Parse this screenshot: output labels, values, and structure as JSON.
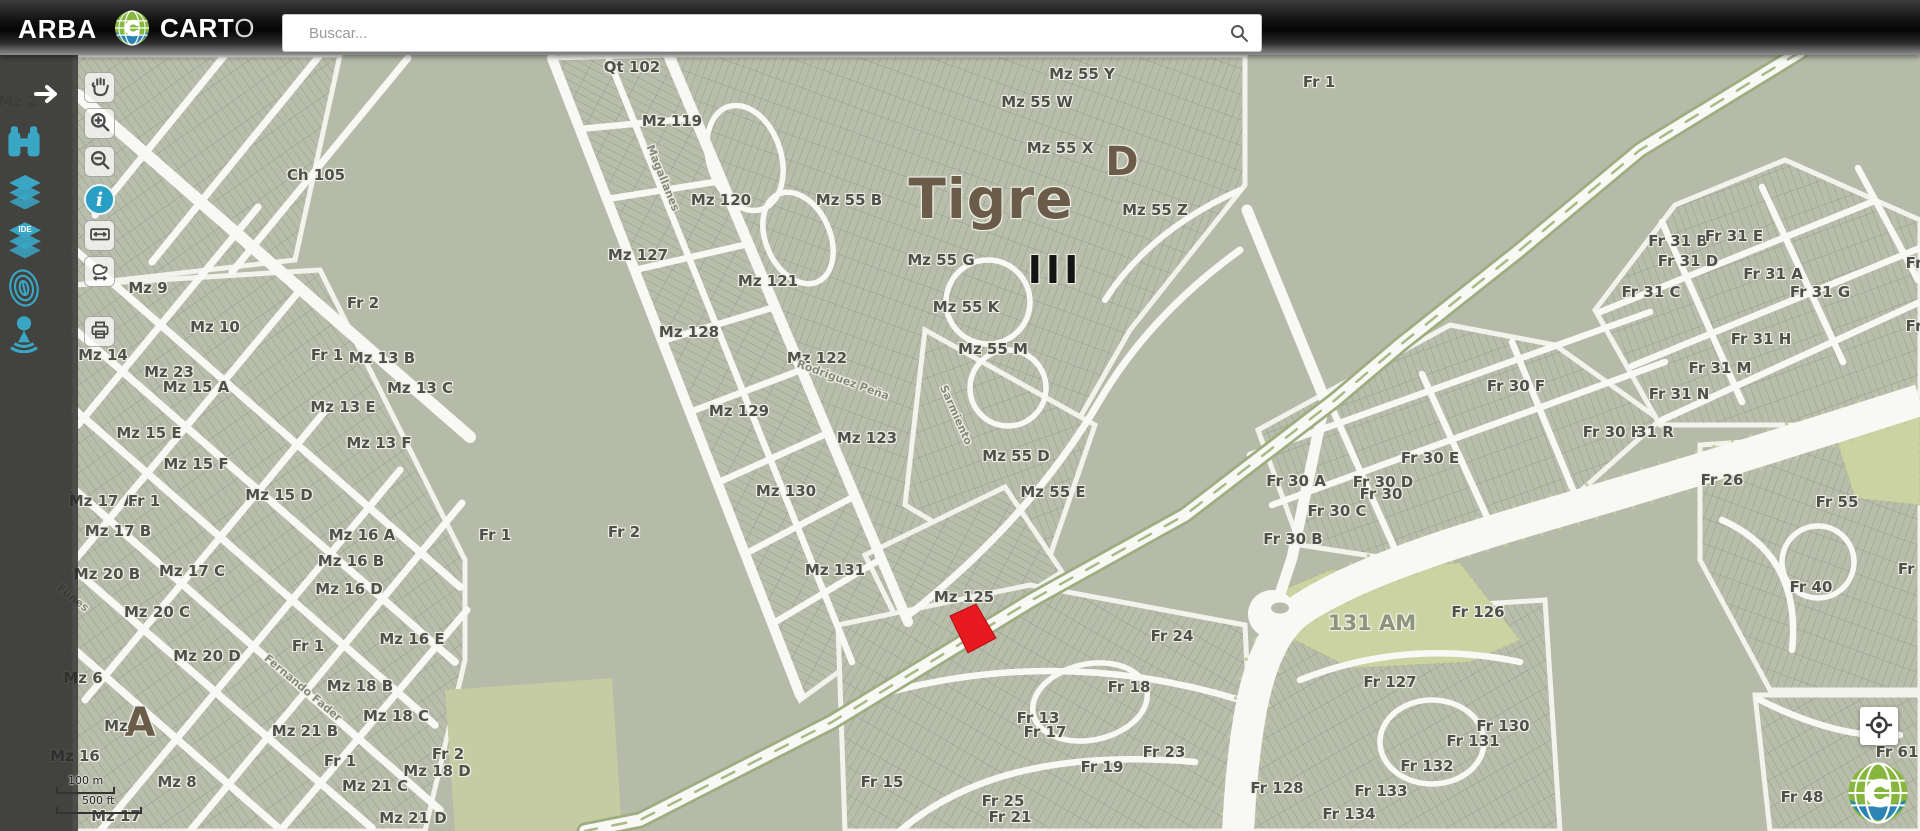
{
  "header": {
    "brand": "ARBA",
    "product": {
      "bold": "CART",
      "light": "O"
    },
    "search": {
      "placeholder": "Buscar...",
      "icon": "search-icon"
    },
    "actions": {
      "mail": {
        "icon": "mail-icon"
      },
      "help": {
        "icon": "help-icon",
        "glyph": "?"
      },
      "logout": {
        "icon": "exit-icon"
      }
    }
  },
  "sidebar": {
    "expand_icon": "arrow-right-icon",
    "tools": [
      {
        "name": "search-parcel",
        "icon": "binoculars-icon"
      },
      {
        "name": "layers",
        "icon": "layers-icon"
      },
      {
        "name": "ide-layers",
        "icon": "ide-layers-icon",
        "badge": "IDE"
      },
      {
        "name": "fingerprint",
        "icon": "fingerprint-icon"
      },
      {
        "name": "street-view",
        "icon": "street-view-icon"
      }
    ]
  },
  "toolbar": {
    "buttons": [
      {
        "name": "pan",
        "icon": "hand-icon",
        "active": false
      },
      {
        "name": "zoom-in",
        "icon": "zoom-in-icon",
        "active": false
      },
      {
        "name": "zoom-out",
        "icon": "zoom-out-icon",
        "active": false
      },
      {
        "name": "identify",
        "icon": "info-icon",
        "glyph": "i",
        "active": true
      },
      {
        "name": "measure-distance",
        "icon": "measure-distance-icon",
        "active": false
      },
      {
        "name": "measure-area",
        "icon": "measure-area-icon",
        "active": false
      },
      {
        "name": "print",
        "icon": "print-icon",
        "active": false
      }
    ]
  },
  "map": {
    "city": "Tigre",
    "selected_parcel_color": "#e8191f",
    "scale": {
      "metric": "100 m",
      "imperial": "500 ft"
    },
    "labels": [
      {
        "text": "Qt 102",
        "x": 632,
        "y": 67
      },
      {
        "text": "Mz 119",
        "x": 672,
        "y": 121
      },
      {
        "text": "Ch 105",
        "x": 316,
        "y": 175
      },
      {
        "text": "Mz 120",
        "x": 721,
        "y": 200
      },
      {
        "text": "Mz 55 B",
        "x": 849,
        "y": 200
      },
      {
        "text": "Mz 55 Y",
        "x": 1082,
        "y": 74
      },
      {
        "text": "Mz 55 W",
        "x": 1037,
        "y": 102
      },
      {
        "text": "Mz 55 X",
        "x": 1060,
        "y": 148
      },
      {
        "text": "D",
        "x": 1122,
        "y": 162,
        "cls": "sec"
      },
      {
        "text": "Mz 55 Z",
        "x": 1155,
        "y": 210
      },
      {
        "text": "Tigre",
        "x": 991,
        "y": 199,
        "cls": "city"
      },
      {
        "text": "Fr 1",
        "x": 1319,
        "y": 82
      },
      {
        "text": "Mz 127",
        "x": 638,
        "y": 255
      },
      {
        "text": "Mz 121",
        "x": 768,
        "y": 281
      },
      {
        "text": "Mz 55 G",
        "x": 941,
        "y": 260
      },
      {
        "text": "III",
        "x": 1055,
        "y": 270,
        "cls": "circ"
      },
      {
        "text": "Mz 9",
        "x": 148,
        "y": 288
      },
      {
        "text": "Fr 2",
        "x": 363,
        "y": 303
      },
      {
        "text": "Mz 10",
        "x": 215,
        "y": 327
      },
      {
        "text": "Mz 128",
        "x": 689,
        "y": 332
      },
      {
        "text": "Mz 55 K",
        "x": 966,
        "y": 307
      },
      {
        "text": "Mz 14",
        "x": 103,
        "y": 355
      },
      {
        "text": "Fr 1",
        "x": 327,
        "y": 355
      },
      {
        "text": "Mz 13 B",
        "x": 382,
        "y": 358
      },
      {
        "text": "Mz 122",
        "x": 817,
        "y": 358
      },
      {
        "text": "Mz 55 M",
        "x": 993,
        "y": 349
      },
      {
        "text": "Mz 23",
        "x": 169,
        "y": 372
      },
      {
        "text": "Mz 15 A",
        "x": 196,
        "y": 387
      },
      {
        "text": "Mz 13 C",
        "x": 420,
        "y": 388
      },
      {
        "text": "Mz 13 E",
        "x": 343,
        "y": 407
      },
      {
        "text": "Mz 129",
        "x": 739,
        "y": 411
      },
      {
        "text": "Mz 15 E",
        "x": 149,
        "y": 433
      },
      {
        "text": "Mz 13 F",
        "x": 379,
        "y": 443
      },
      {
        "text": "Mz 123",
        "x": 867,
        "y": 438
      },
      {
        "text": "Mz 55 D",
        "x": 1016,
        "y": 456
      },
      {
        "text": "Mz 15 F",
        "x": 196,
        "y": 464
      },
      {
        "text": "Mz 55 E",
        "x": 1053,
        "y": 492
      },
      {
        "text": "Mz 17 A",
        "x": 102,
        "y": 501
      },
      {
        "text": "Fr 1",
        "x": 144,
        "y": 501
      },
      {
        "text": "Mz 15 D",
        "x": 279,
        "y": 495
      },
      {
        "text": "Mz 130",
        "x": 786,
        "y": 491
      },
      {
        "text": "Mz 17 B",
        "x": 118,
        "y": 531
      },
      {
        "text": "Mz 16 A",
        "x": 362,
        "y": 535
      },
      {
        "text": "Fr 1",
        "x": 495,
        "y": 535
      },
      {
        "text": "Fr 2",
        "x": 624,
        "y": 532
      },
      {
        "text": "Mz 16 B",
        "x": 351,
        "y": 561
      },
      {
        "text": "Mz 131",
        "x": 835,
        "y": 570
      },
      {
        "text": "Mz 20 B",
        "x": 107,
        "y": 574
      },
      {
        "text": "Mz 17 C",
        "x": 192,
        "y": 571
      },
      {
        "text": "Mz 16 D",
        "x": 349,
        "y": 589
      },
      {
        "text": "Mz 125",
        "x": 964,
        "y": 597
      },
      {
        "text": "Mz 20 C",
        "x": 157,
        "y": 612
      },
      {
        "text": "Mz 16 E",
        "x": 412,
        "y": 639
      },
      {
        "text": "Fr 1",
        "x": 308,
        "y": 646
      },
      {
        "text": "Mz 20 D",
        "x": 207,
        "y": 656
      },
      {
        "text": "Mz 6",
        "x": 83,
        "y": 678
      },
      {
        "text": "Mz 18 B",
        "x": 360,
        "y": 686
      },
      {
        "text": "A",
        "x": 140,
        "y": 723,
        "cls": "sec"
      },
      {
        "text": "Mz",
        "x": 116,
        "y": 726
      },
      {
        "text": "Mz 18 C",
        "x": 396,
        "y": 716
      },
      {
        "text": "Mz 21 B",
        "x": 305,
        "y": 731
      },
      {
        "text": "Mz 16",
        "x": 75,
        "y": 756
      },
      {
        "text": "Fr 1",
        "x": 340,
        "y": 761
      },
      {
        "text": "Fr 2",
        "x": 448,
        "y": 754
      },
      {
        "text": "Mz 18 D",
        "x": 437,
        "y": 771
      },
      {
        "text": "Mz 8",
        "x": 177,
        "y": 782
      },
      {
        "text": "Mz 21 C",
        "x": 375,
        "y": 786
      },
      {
        "text": "Mz 17",
        "x": 116,
        "y": 816
      },
      {
        "text": "Mz 21 D",
        "x": 413,
        "y": 818
      },
      {
        "text": "Fr 24",
        "x": 1172,
        "y": 636
      },
      {
        "text": "Fr 18",
        "x": 1129,
        "y": 687
      },
      {
        "text": "Fr 13",
        "x": 1038,
        "y": 718
      },
      {
        "text": "Fr 17",
        "x": 1045,
        "y": 732
      },
      {
        "text": "Fr 23",
        "x": 1164,
        "y": 752
      },
      {
        "text": "Fr 19",
        "x": 1102,
        "y": 767
      },
      {
        "text": "Fr 15",
        "x": 882,
        "y": 782
      },
      {
        "text": "Fr 25",
        "x": 1003,
        "y": 801
      },
      {
        "text": "Fr 21",
        "x": 1010,
        "y": 817
      },
      {
        "text": "Fr 128",
        "x": 1277,
        "y": 788
      },
      {
        "text": "131 AM",
        "x": 1372,
        "y": 623,
        "cls": "area"
      },
      {
        "text": "Fr 126",
        "x": 1478,
        "y": 612
      },
      {
        "text": "Fr 127",
        "x": 1390,
        "y": 682
      },
      {
        "text": "Fr 130",
        "x": 1503,
        "y": 726
      },
      {
        "text": "Fr 131",
        "x": 1473,
        "y": 741
      },
      {
        "text": "Fr 132",
        "x": 1427,
        "y": 766
      },
      {
        "text": "Fr 133",
        "x": 1381,
        "y": 791
      },
      {
        "text": "Fr 134",
        "x": 1349,
        "y": 814
      },
      {
        "text": "Fr 30 F",
        "x": 1516,
        "y": 386
      },
      {
        "text": "Fr 30 E",
        "x": 1430,
        "y": 458
      },
      {
        "text": "Fr 30 A",
        "x": 1296,
        "y": 481
      },
      {
        "text": "Fr 30 D",
        "x": 1383,
        "y": 482
      },
      {
        "text": "Fr 30",
        "x": 1381,
        "y": 494
      },
      {
        "text": "Fr 30 C",
        "x": 1337,
        "y": 511
      },
      {
        "text": "Fr 30 B",
        "x": 1293,
        "y": 539
      },
      {
        "text": "Fr 30 H",
        "x": 1613,
        "y": 432
      },
      {
        "text": "31 R",
        "x": 1655,
        "y": 432
      },
      {
        "text": "Fr 31 B",
        "x": 1678,
        "y": 241
      },
      {
        "text": "Fr 31 E",
        "x": 1734,
        "y": 236
      },
      {
        "text": "Fr 31 D",
        "x": 1688,
        "y": 261
      },
      {
        "text": "Fr 31 A",
        "x": 1773,
        "y": 274
      },
      {
        "text": "Fr 31 C",
        "x": 1651,
        "y": 292
      },
      {
        "text": "Fr 31 G",
        "x": 1820,
        "y": 292
      },
      {
        "text": "Fr 31 H",
        "x": 1761,
        "y": 339
      },
      {
        "text": "Fr 31 M",
        "x": 1720,
        "y": 368
      },
      {
        "text": "Fr 31 N",
        "x": 1679,
        "y": 394
      },
      {
        "text": "Fr 26",
        "x": 1722,
        "y": 480
      },
      {
        "text": "Fr 55",
        "x": 1837,
        "y": 502
      },
      {
        "text": "Fr 40",
        "x": 1811,
        "y": 587
      },
      {
        "text": "Fr 3",
        "x": 1914,
        "y": 569
      },
      {
        "text": "Fr",
        "x": 1914,
        "y": 263
      },
      {
        "text": "Fr",
        "x": 1914,
        "y": 326
      },
      {
        "text": "Fr 61",
        "x": 1897,
        "y": 752
      },
      {
        "text": "Fr 48",
        "x": 1802,
        "y": 797
      },
      {
        "text": "Mz 2",
        "x": 18,
        "y": 101,
        "cls": "dim"
      },
      {
        "text": "Magallanes",
        "x": 663,
        "y": 178,
        "cls": "street",
        "rot": 68
      },
      {
        "text": "Rodriguez Peña",
        "x": 843,
        "y": 380,
        "cls": "street",
        "rot": 20
      },
      {
        "text": "Sarmiento",
        "x": 956,
        "y": 415,
        "cls": "street",
        "rot": 66
      },
      {
        "text": "Fernando Fader",
        "x": 303,
        "y": 688,
        "cls": "street",
        "rot": 40
      },
      {
        "text": "Funes",
        "x": 73,
        "y": 598,
        "cls": "street",
        "rot": 38
      }
    ]
  },
  "controls": {
    "locate_icon": "crosshair-icon",
    "watermark_icon": "carto-globe-icon"
  },
  "colors": {
    "accent_teal": "#2fa3c6",
    "map_base": "#b6baa8",
    "street_white": "#f8f9f5",
    "parcel_highlight": "#e8191f",
    "light_green": "#ccd3a3",
    "city_label": "#6b5b49",
    "avenue_green": "#9dad80"
  }
}
